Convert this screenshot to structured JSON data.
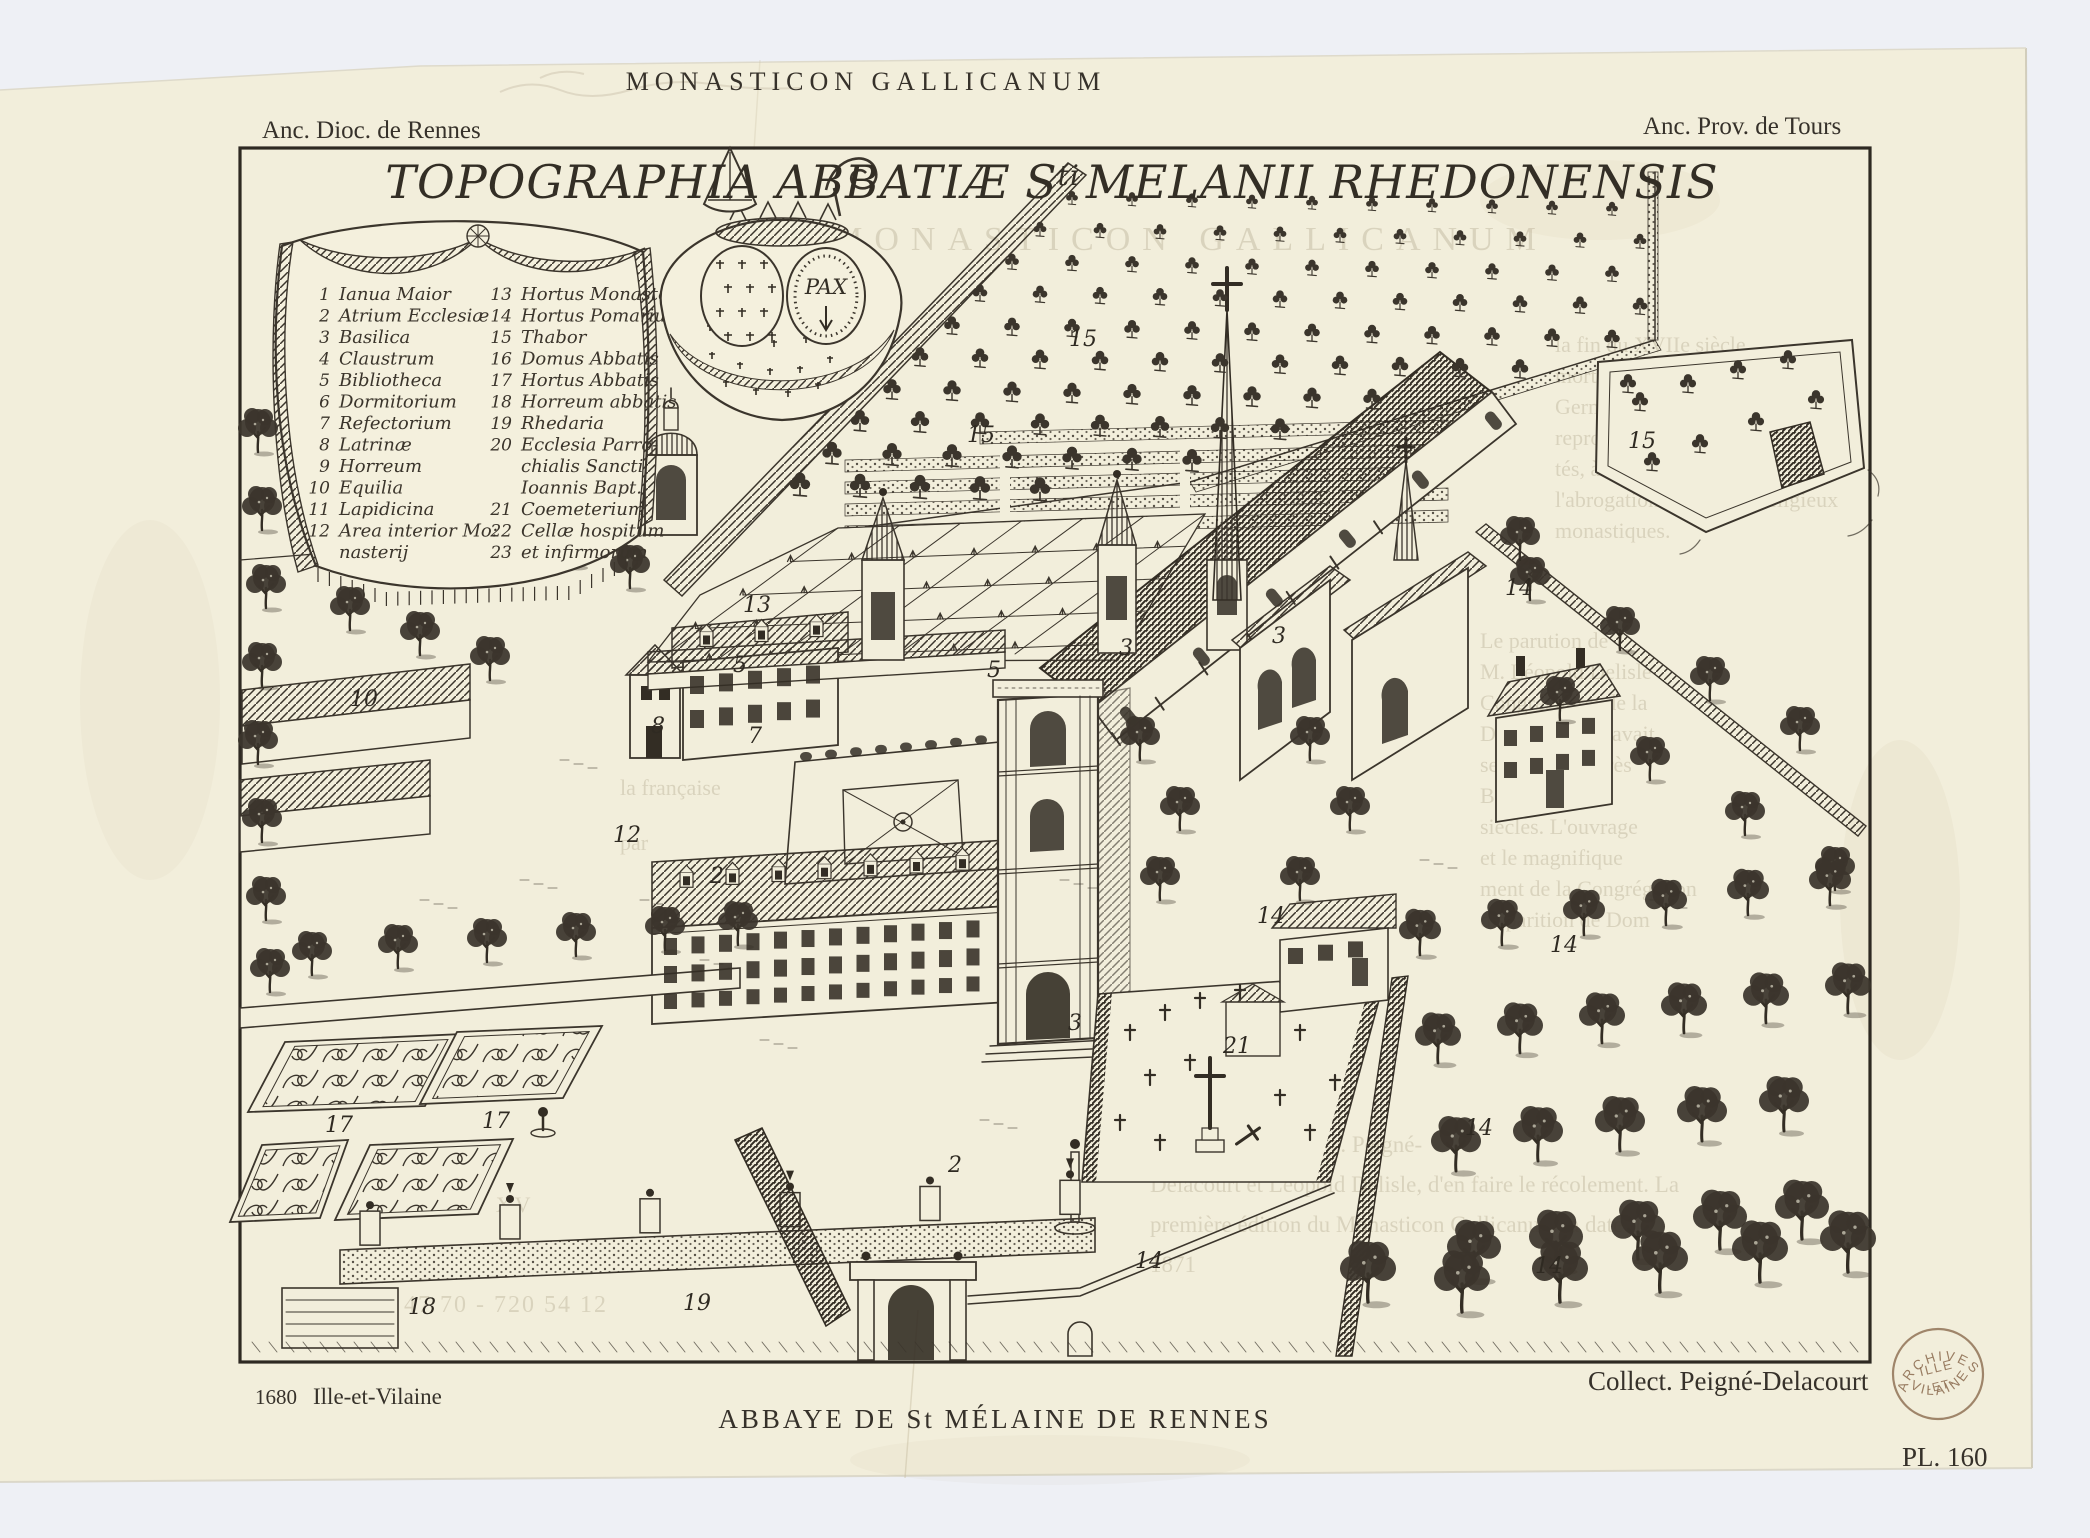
{
  "header": {
    "series_title": "MONASTICON GALLICANUM",
    "left_note": "Anc. Dioc. de Rennes",
    "right_note": "Anc. Prov. de Tours"
  },
  "plate": {
    "engraved_title": {
      "part1": "TOPOGRAPHIA ABBATIÆ S",
      "superscript": "ti",
      "part2": "MELANII RHEDONENSIS"
    },
    "heraldry_motto": "PAX",
    "legend": {
      "left": [
        {
          "n": "1",
          "label": "Ianua Maior"
        },
        {
          "n": "2",
          "label": "Atrium Ecclesiæ"
        },
        {
          "n": "3",
          "label": "Basilica"
        },
        {
          "n": "4",
          "label": "Claustrum"
        },
        {
          "n": "5",
          "label": "Bibliotheca"
        },
        {
          "n": "6",
          "label": "Dormitorium"
        },
        {
          "n": "7",
          "label": "Refectorium"
        },
        {
          "n": "8",
          "label": "Latrinæ"
        },
        {
          "n": "9",
          "label": "Horreum"
        },
        {
          "n": "10",
          "label": "Equilia"
        },
        {
          "n": "11",
          "label": "Lapidicina"
        },
        {
          "n": "12",
          "label": "Area interior Mo:"
        },
        {
          "n": "",
          "label": "nasterij"
        }
      ],
      "right": [
        {
          "n": "13",
          "label": "Hortus Monasterij"
        },
        {
          "n": "14",
          "label": "Hortus Pomarius"
        },
        {
          "n": "15",
          "label": "Thabor"
        },
        {
          "n": "16",
          "label": "Domus Abbatis"
        },
        {
          "n": "17",
          "label": "Hortus Abbatis"
        },
        {
          "n": "18",
          "label": "Horreum abbatis"
        },
        {
          "n": "19",
          "label": "Rhedaria"
        },
        {
          "n": "20",
          "label": "Ecclesia Parro-"
        },
        {
          "n": "",
          "label": "chialis Sancti"
        },
        {
          "n": "",
          "label": "Ioannis Bapt."
        },
        {
          "n": "21",
          "label": "Coemeterium"
        },
        {
          "n": "22",
          "label": "Cellæ hospitum"
        },
        {
          "n": "23",
          "label": "et infirmorum"
        }
      ]
    },
    "plan_labels": [
      {
        "n": "15",
        "x": 1069,
        "y": 346
      },
      {
        "n": "15",
        "x": 967,
        "y": 442
      },
      {
        "n": "15",
        "x": 1628,
        "y": 448
      },
      {
        "n": "13",
        "x": 743,
        "y": 612
      },
      {
        "n": "14",
        "x": 1505,
        "y": 595
      },
      {
        "n": "3",
        "x": 1119,
        "y": 655
      },
      {
        "n": "3",
        "x": 1272,
        "y": 643
      },
      {
        "n": "3",
        "x": 1068,
        "y": 1030
      },
      {
        "n": "5",
        "x": 733,
        "y": 672
      },
      {
        "n": "5",
        "x": 987,
        "y": 677
      },
      {
        "n": "7",
        "x": 748,
        "y": 743
      },
      {
        "n": "8",
        "x": 651,
        "y": 733
      },
      {
        "n": "12",
        "x": 613,
        "y": 842
      },
      {
        "n": "10",
        "x": 350,
        "y": 706
      },
      {
        "n": "2",
        "x": 710,
        "y": 883
      },
      {
        "n": "2",
        "x": 948,
        "y": 1172
      },
      {
        "n": "21",
        "x": 1223,
        "y": 1053
      },
      {
        "n": "14",
        "x": 1257,
        "y": 923
      },
      {
        "n": "14",
        "x": 1550,
        "y": 952
      },
      {
        "n": "14",
        "x": 1465,
        "y": 1135
      },
      {
        "n": "14",
        "x": 1135,
        "y": 1268
      },
      {
        "n": "14",
        "x": 1535,
        "y": 1273
      },
      {
        "n": "17",
        "x": 325,
        "y": 1132
      },
      {
        "n": "17",
        "x": 482,
        "y": 1128
      },
      {
        "n": "18",
        "x": 408,
        "y": 1314
      },
      {
        "n": "19",
        "x": 683,
        "y": 1310
      }
    ]
  },
  "footer": {
    "date": "1680",
    "department": "Ille-et-Vilaine",
    "collection": "Collect. Peigné-Delacourt",
    "caption": "ABBAYE DE St MÉLAINE DE RENNES",
    "plate_number": "PL. 160"
  },
  "stamp": {
    "arc_top": "ARCHIVES",
    "line_mid": "ILLE",
    "line_mid2": "-ET-",
    "arc_bottom": "VILAINE",
    "color": "#8a6a4e"
  },
  "ghost_text": {
    "heading": "MONASTICON GALLICANUM",
    "blocks": [
      {
        "lines": [
          "la fin du XVIIe siècle",
          "mort de son initiateur",
          "Germain des Prés",
          "reproduisant alors les",
          "tés, à l'exception",
          "l'abrogation des ordres religieux",
          "monastiques."
        ]
      },
      {
        "lines": [
          "Le parution de",
          "M. Léopold Delisle",
          "Congrégation de la",
          "Dom Germain avait",
          "sentation, d'après",
          "Bien que nom",
          "siècles. L'ouvrage",
          "et le magnifique",
          "ment de la Congrégation",
          "disparition de Dom"
        ]
      },
      {
        "lines": [
          "Les gravures",
          "du XIXe siècle, MM. Peigné-",
          "Delacourt et Léopold Delisle, d'en faire le récolement. La",
          "première édition du Monasticon Gallicanum, a date de",
          "1871"
        ]
      },
      {
        "lines": [
          "la française",
          "par"
        ]
      },
      {
        "lines": [
          "MITES DU XV"
        ]
      },
      {
        "lines": [
          "56 47 70 - 720 54 12"
        ]
      }
    ]
  }
}
